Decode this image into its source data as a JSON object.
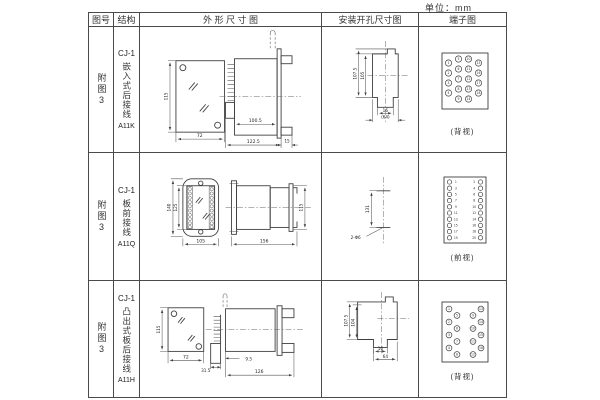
{
  "page": {
    "unit": "单位：mm"
  },
  "colors": {
    "line": "#3f3f3f",
    "text": "#222222",
    "background": "#ffffff"
  },
  "header": {
    "col_figure": "图号",
    "col_structure": "结构",
    "col_outline": "外 形 尺 寸 图",
    "col_mounting": "安装开孔尺寸图",
    "col_terminal": "端子图"
  },
  "rows": [
    {
      "figure": "附图3",
      "structure_model": "CJ-1",
      "structure_type": "嵌入式后接线",
      "structure_code": "A11K",
      "outline": {
        "height": "115",
        "width": "72",
        "body_len": "100.5",
        "total_len": "122.5",
        "flange": "15"
      },
      "mounting": {
        "outer": "107.5",
        "inner": "105",
        "slot": "16",
        "overall": "(64)"
      },
      "terminal": {
        "view": "(背视)",
        "numbers": [
          1,
          2,
          3,
          4,
          5,
          6,
          7,
          8,
          9,
          10,
          11,
          12,
          13,
          14,
          15,
          16,
          17,
          18
        ]
      }
    },
    {
      "figure": "附图3",
      "structure_model": "CJ-1",
      "structure_type": "板前接线",
      "structure_code": "A11Q",
      "outline": {
        "outer_h": "140",
        "inner_h": "125",
        "width": "105",
        "length": "156",
        "side_h": "115"
      },
      "mounting": {
        "spacing": "131",
        "holes": "2-Φ6"
      },
      "terminal": {
        "view": "(前视)",
        "numbers": [
          1,
          3,
          5,
          7,
          9,
          11,
          13,
          15,
          17,
          19,
          2,
          4,
          6,
          8,
          10,
          12,
          14,
          16,
          18,
          20
        ]
      }
    },
    {
      "figure": "附图3",
      "structure_model": "CJ-1",
      "structure_type": "凸出式板后接线",
      "structure_code": "A11H",
      "outline": {
        "height": "115",
        "width": "72",
        "pin_len": "31.5",
        "gap": "9.5",
        "body_len": "126"
      },
      "mounting": {
        "outer": "107.5",
        "inner": "104",
        "slot": "16",
        "overall": "64"
      },
      "terminal": {
        "view": "(背视)",
        "numbers": [
          1,
          2,
          3,
          4,
          5,
          6,
          7,
          8,
          9,
          10,
          11,
          12,
          13,
          14,
          15,
          16
        ]
      }
    }
  ]
}
